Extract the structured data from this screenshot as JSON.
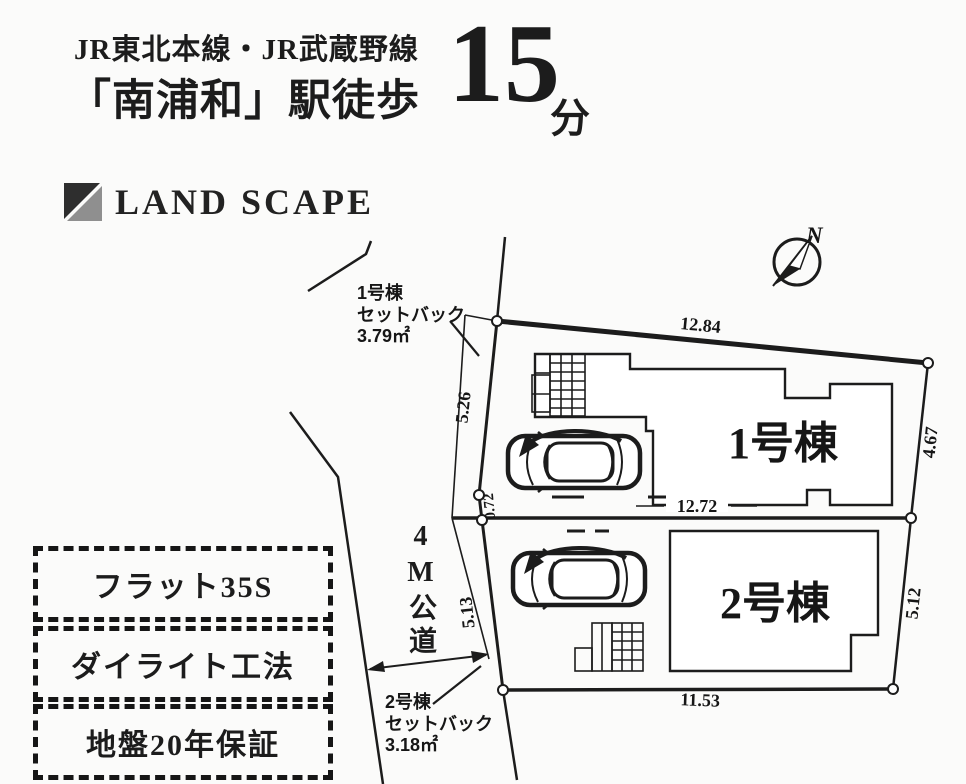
{
  "header": {
    "rail_lines": "JR東北本線・JR武蔵野線",
    "station_walk": "「南浦和」駅徒歩",
    "minutes_value": "15",
    "minutes_unit": "分"
  },
  "brand": {
    "name": "LAND SCAPE",
    "logo_dark_color": "#2e2e2e",
    "logo_gray_color": "#8f8f8f"
  },
  "features": [
    {
      "label": "フラット35S"
    },
    {
      "label": "ダイライト工法"
    },
    {
      "label": "地盤20年保証"
    }
  ],
  "site_plan": {
    "road_label": "4M公道",
    "north_label": "N",
    "line_color": "#1c1c1c",
    "lots": [
      {
        "name": "1号棟",
        "setback_line1": "1号棟",
        "setback_line2": "セットバック",
        "setback_line3": "3.79㎡"
      },
      {
        "name": "2号棟",
        "setback_line1": "2号棟",
        "setback_line2": "セットバック",
        "setback_line3": "3.18㎡"
      }
    ],
    "dimensions": {
      "top": "12.84",
      "right_upper": "4.67",
      "left_upper": "5.26",
      "left_mid": "0.72",
      "inner": "12.72",
      "left_lower": "5.13",
      "right_lower": "5.12",
      "bottom": "11.53"
    }
  }
}
